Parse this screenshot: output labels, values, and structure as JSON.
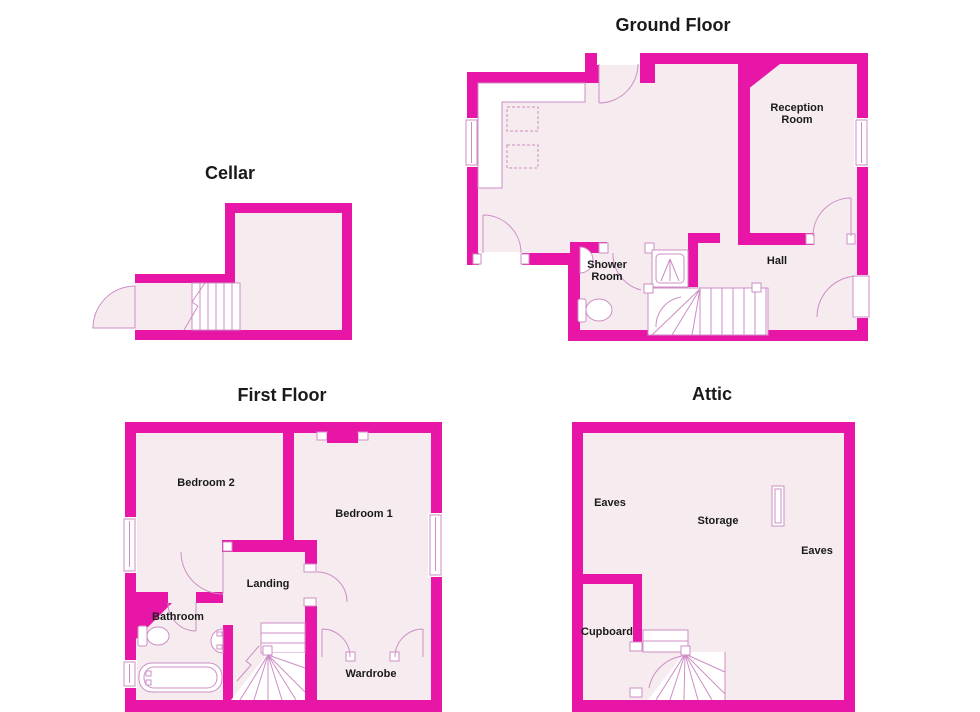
{
  "colors": {
    "wall": "#E816A6",
    "floor": "#F6ECEF",
    "fixture_line": "#CC8EC4",
    "label": "#1A1A1A",
    "background": "#FFFFFF"
  },
  "cellar": {
    "title": "Cellar"
  },
  "ground_floor": {
    "title": "Ground Floor",
    "labels": {
      "reception_line1": "Reception",
      "reception_line2": "Room",
      "shower_line1": "Shower",
      "shower_line2": "Room",
      "hall": "Hall"
    }
  },
  "first_floor": {
    "title": "First Floor",
    "labels": {
      "bedroom2": "Bedroom 2",
      "bedroom1": "Bedroom 1",
      "landing": "Landing",
      "bathroom": "Bathroom",
      "wardrobe": "Wardrobe"
    }
  },
  "attic": {
    "title": "Attic",
    "labels": {
      "eaves_left": "Eaves",
      "storage": "Storage",
      "eaves_right": "Eaves",
      "cupboard": "Cupboard"
    }
  }
}
